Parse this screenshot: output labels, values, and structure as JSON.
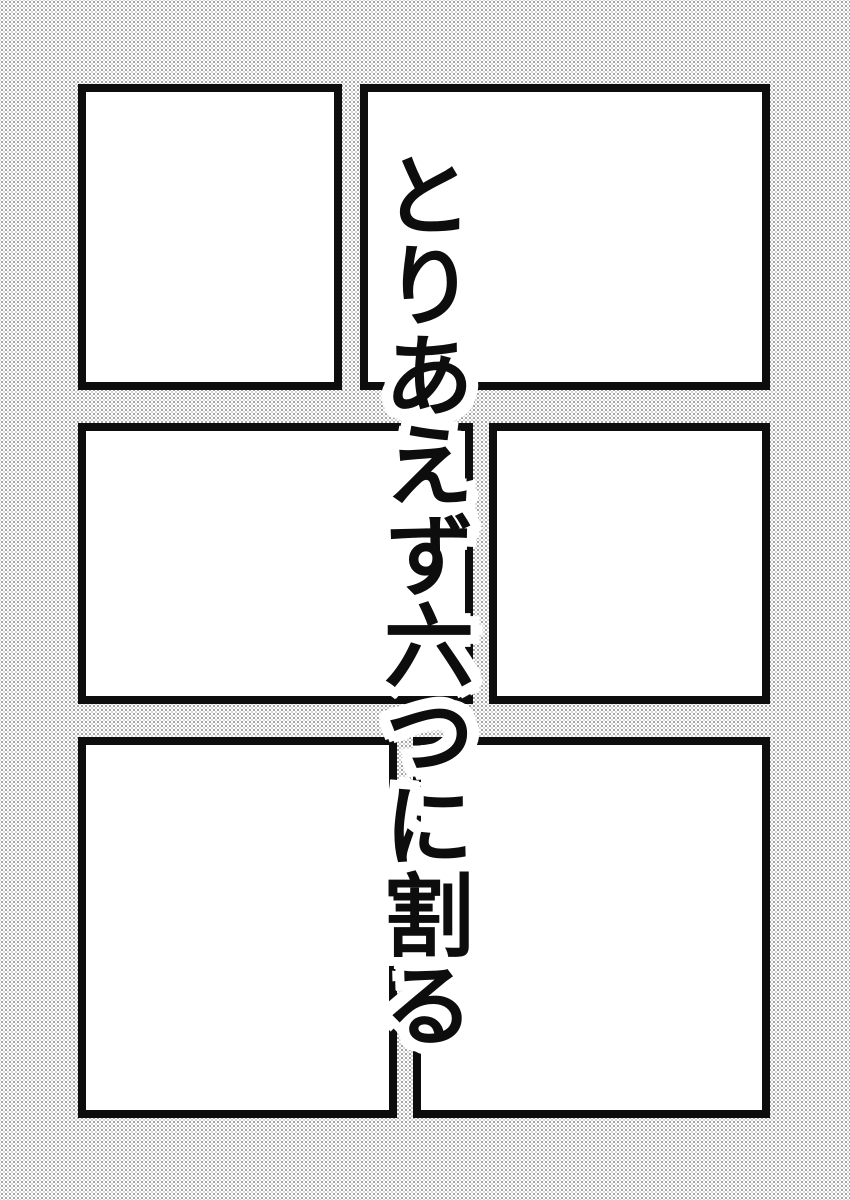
{
  "caption": {
    "text": "とりあえず六つに割る"
  },
  "page": {
    "kind": "manga-page-draft",
    "panel_count": 6,
    "panels": [
      {
        "name": "top-left"
      },
      {
        "name": "top-right"
      },
      {
        "name": "middle-left"
      },
      {
        "name": "middle-right"
      },
      {
        "name": "bottom-left"
      },
      {
        "name": "bottom-right"
      }
    ]
  },
  "colors": {
    "ink": "#0d0d0d",
    "paper": "#ffffff",
    "text_outline": "#ffffff",
    "halftone_dot_dark": "#8e8e8e",
    "halftone_dot_light": "#cccccc"
  }
}
